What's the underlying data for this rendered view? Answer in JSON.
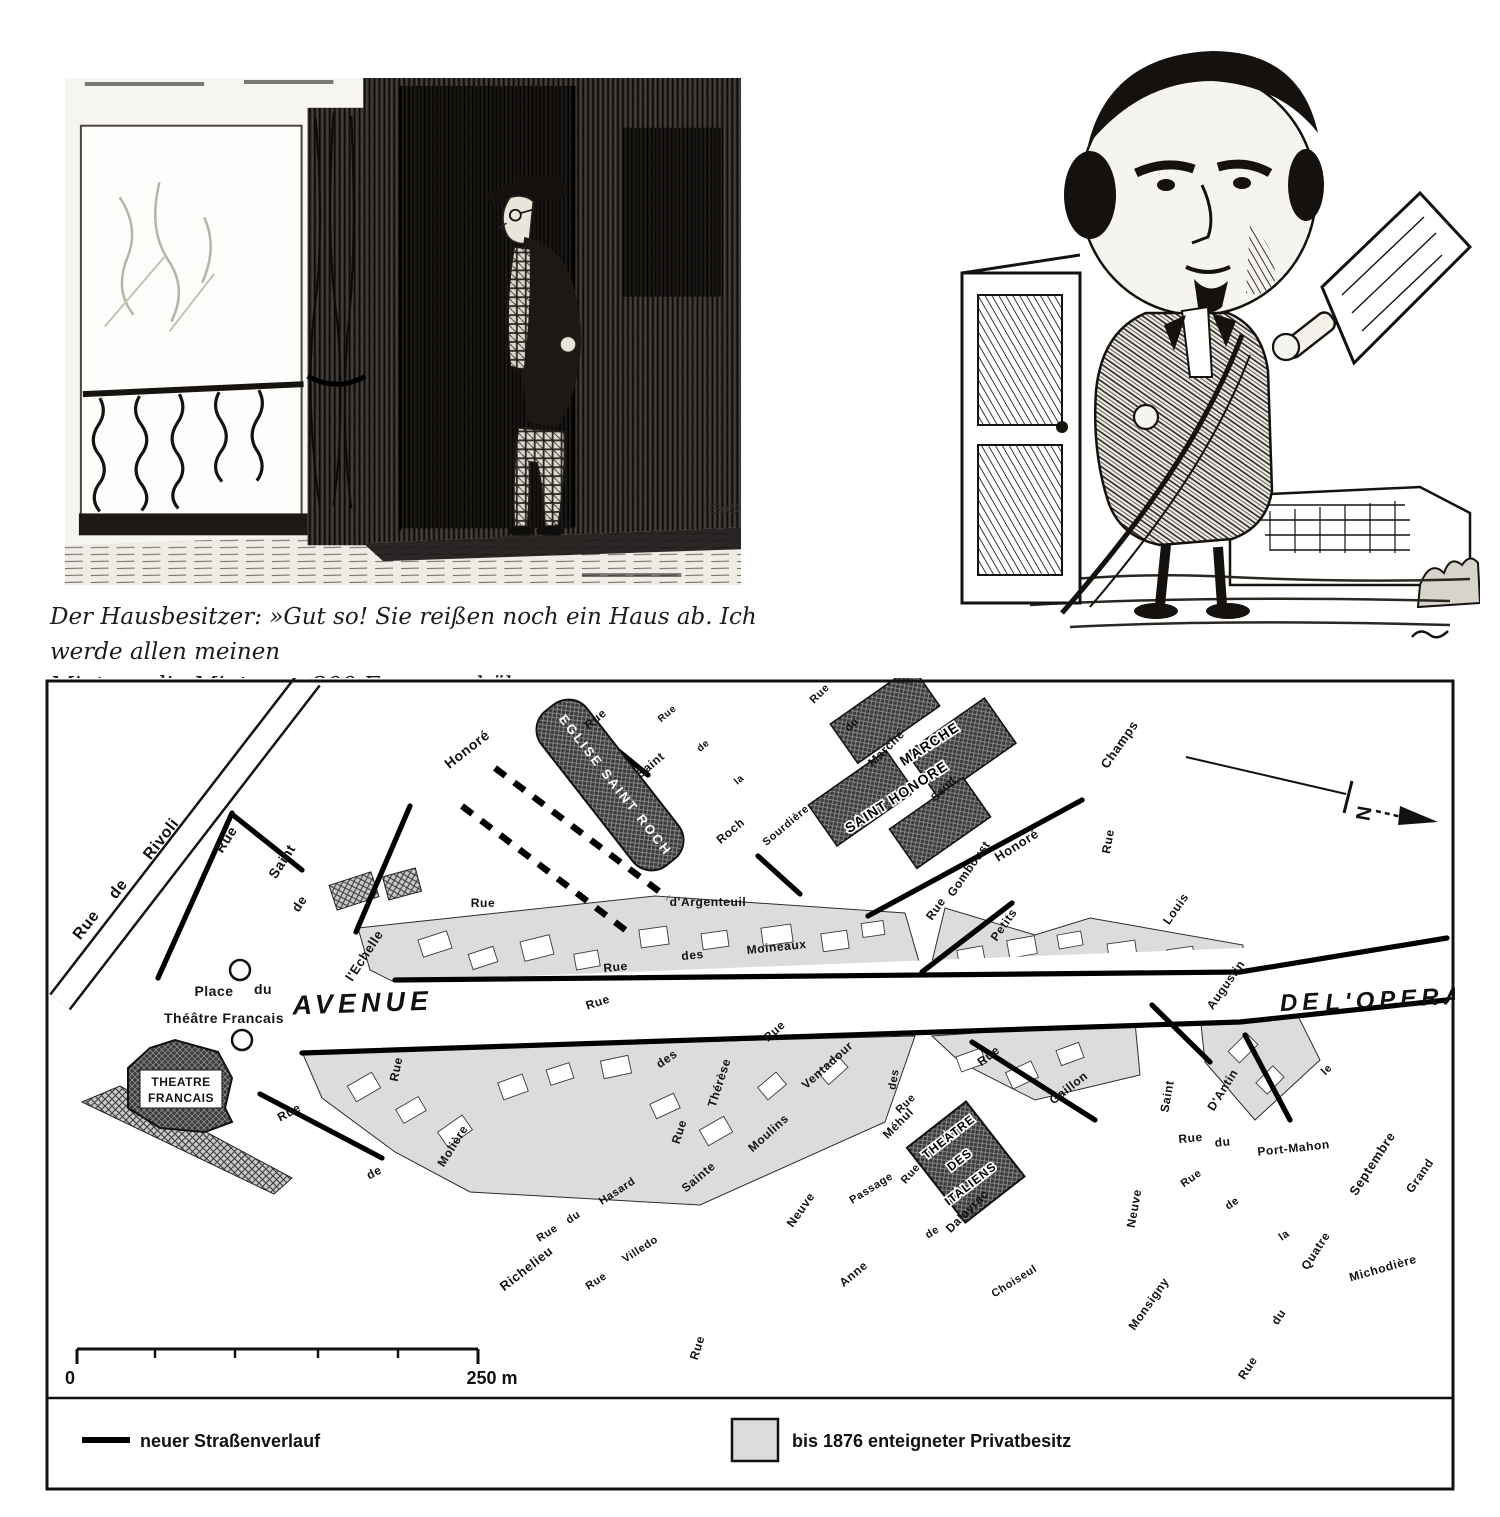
{
  "caption": {
    "lines": [
      "Der Hausbesitzer: »Gut so! Sie reißen noch ein Haus ab. Ich werde allen meinen",
      "Mietern die Miete um 200 Francs erhöhen.«"
    ]
  },
  "illustrations": {
    "left_signature": "GoS"
  },
  "map": {
    "colors": {
      "expropriated_fill": "#dcdcdc",
      "ink": "#111111",
      "new_street": "#000000"
    },
    "north_label": "N",
    "scale": {
      "zero": "0",
      "end": "250 m"
    },
    "legend": {
      "items": [
        {
          "swatch": "line",
          "label": "neuer Straßenverlauf"
        },
        {
          "swatch": "area",
          "label": "bis 1876 enteigneter Privatbesitz"
        }
      ]
    },
    "street_labels": [
      {
        "t": "Rue",
        "x": 90,
        "y": 928,
        "r": -52,
        "s": 16
      },
      {
        "t": "de",
        "x": 122,
        "y": 892,
        "r": -52,
        "s": 16
      },
      {
        "t": "Rivoli",
        "x": 165,
        "y": 842,
        "r": -52,
        "s": 16
      },
      {
        "t": "Rue",
        "x": 230,
        "y": 842,
        "r": -57,
        "s": 14
      },
      {
        "t": "Saint",
        "x": 286,
        "y": 864,
        "r": -57,
        "s": 14
      },
      {
        "t": "de",
        "x": 303,
        "y": 906,
        "r": -57,
        "s": 13
      },
      {
        "t": "l'Echelle",
        "x": 368,
        "y": 958,
        "r": -57,
        "s": 13
      },
      {
        "t": "Honoré",
        "x": 470,
        "y": 753,
        "r": -38,
        "s": 14
      },
      {
        "t": "Rue",
        "x": 598,
        "y": 722,
        "r": -40,
        "s": 12
      },
      {
        "t": "Saint",
        "x": 653,
        "y": 768,
        "r": -40,
        "s": 12
      },
      {
        "t": "Roch",
        "x": 733,
        "y": 834,
        "r": -40,
        "s": 12
      },
      {
        "t": "Rue",
        "x": 669,
        "y": 716,
        "r": -40,
        "s": 10
      },
      {
        "t": "de",
        "x": 705,
        "y": 748,
        "r": -40,
        "s": 10
      },
      {
        "t": "la",
        "x": 741,
        "y": 782,
        "r": -40,
        "s": 10
      },
      {
        "t": "Sourdière",
        "x": 788,
        "y": 828,
        "r": -40,
        "s": 11
      },
      {
        "t": "Rue",
        "x": 483,
        "y": 907,
        "r": 0,
        "s": 12
      },
      {
        "t": "d'Argenteuil",
        "x": 708,
        "y": 906,
        "r": 0,
        "s": 12
      },
      {
        "t": "Rue",
        "x": 616,
        "y": 971,
        "r": -6,
        "s": 12
      },
      {
        "t": "des",
        "x": 693,
        "y": 959,
        "r": -6,
        "s": 12
      },
      {
        "t": "Moineaux",
        "x": 777,
        "y": 951,
        "r": -6,
        "s": 12
      },
      {
        "t": "Rue",
        "x": 599,
        "y": 1006,
        "r": -18,
        "s": 12
      },
      {
        "t": "des",
        "x": 669,
        "y": 1062,
        "r": -35,
        "s": 12
      },
      {
        "t": "Rue",
        "x": 400,
        "y": 1070,
        "r": -78,
        "s": 12
      },
      {
        "t": "Molière",
        "x": 456,
        "y": 1148,
        "r": -58,
        "s": 12
      },
      {
        "t": "Rue",
        "x": 291,
        "y": 1116,
        "r": -28,
        "s": 12
      },
      {
        "t": "de",
        "x": 376,
        "y": 1176,
        "r": -28,
        "s": 12
      },
      {
        "t": "Richelieu",
        "x": 529,
        "y": 1272,
        "r": -38,
        "s": 13
      },
      {
        "t": "Rue",
        "x": 549,
        "y": 1236,
        "r": -33,
        "s": 11
      },
      {
        "t": "du",
        "x": 575,
        "y": 1220,
        "r": -33,
        "s": 11
      },
      {
        "t": "Hasard",
        "x": 619,
        "y": 1194,
        "r": -33,
        "s": 11
      },
      {
        "t": "Rue",
        "x": 598,
        "y": 1284,
        "r": -33,
        "s": 11
      },
      {
        "t": "Villedo",
        "x": 642,
        "y": 1252,
        "r": -33,
        "s": 11
      },
      {
        "t": "Sainte",
        "x": 701,
        "y": 1180,
        "r": -40,
        "s": 12
      },
      {
        "t": "Anne",
        "x": 856,
        "y": 1277,
        "r": -40,
        "s": 12
      },
      {
        "t": "Rue",
        "x": 701,
        "y": 1349,
        "r": -72,
        "s": 12
      },
      {
        "t": "Rue",
        "x": 683,
        "y": 1133,
        "r": -72,
        "s": 12
      },
      {
        "t": "Thérèse",
        "x": 723,
        "y": 1084,
        "r": -72,
        "s": 12
      },
      {
        "t": "Moulins",
        "x": 771,
        "y": 1136,
        "r": -42,
        "s": 12
      },
      {
        "t": "des",
        "x": 897,
        "y": 1080,
        "r": -80,
        "s": 11
      },
      {
        "t": "Rue",
        "x": 908,
        "y": 1106,
        "r": -45,
        "s": 11
      },
      {
        "t": "Méhul",
        "x": 901,
        "y": 1126,
        "r": -45,
        "s": 12
      },
      {
        "t": "Rue",
        "x": 777,
        "y": 1034,
        "r": -42,
        "s": 12
      },
      {
        "t": "Ventadour",
        "x": 830,
        "y": 1068,
        "r": -42,
        "s": 12
      },
      {
        "t": "Rue",
        "x": 913,
        "y": 1176,
        "r": -48,
        "s": 11
      },
      {
        "t": "Dalayrac",
        "x": 970,
        "y": 1214,
        "r": -45,
        "s": 12
      },
      {
        "t": "Passage",
        "x": 873,
        "y": 1191,
        "r": -32,
        "s": 11
      },
      {
        "t": "de",
        "x": 934,
        "y": 1235,
        "r": -32,
        "s": 11
      },
      {
        "t": "Choiseul",
        "x": 1016,
        "y": 1284,
        "r": -32,
        "s": 11
      },
      {
        "t": "Rue",
        "x": 991,
        "y": 1059,
        "r": -38,
        "s": 12
      },
      {
        "t": "Gaillon",
        "x": 1071,
        "y": 1091,
        "r": -38,
        "s": 12
      },
      {
        "t": "Petits",
        "x": 1007,
        "y": 927,
        "r": -55,
        "s": 12
      },
      {
        "t": "Champs",
        "x": 1123,
        "y": 747,
        "r": -55,
        "s": 13
      },
      {
        "t": "Rue",
        "x": 939,
        "y": 911,
        "r": -55,
        "s": 12
      },
      {
        "t": "Gomboust",
        "x": 972,
        "y": 871,
        "r": -55,
        "s": 12
      },
      {
        "t": "Honoré",
        "x": 1019,
        "y": 849,
        "r": -32,
        "s": 13
      },
      {
        "t": "Rue",
        "x": 822,
        "y": 696,
        "r": -45,
        "s": 11
      },
      {
        "t": "du",
        "x": 854,
        "y": 727,
        "r": -45,
        "s": 11
      },
      {
        "t": "Marché",
        "x": 889,
        "y": 751,
        "r": -45,
        "s": 12
      },
      {
        "t": "Saint",
        "x": 946,
        "y": 791,
        "r": -45,
        "s": 11
      },
      {
        "t": "Rue",
        "x": 1112,
        "y": 842,
        "r": -80,
        "s": 12
      },
      {
        "t": "Louis",
        "x": 1179,
        "y": 911,
        "r": -55,
        "s": 12
      },
      {
        "t": "le",
        "x": 1329,
        "y": 1072,
        "r": -45,
        "s": 11
      },
      {
        "t": "Grand",
        "x": 1423,
        "y": 1178,
        "r": -55,
        "s": 12
      },
      {
        "t": "Saint",
        "x": 1171,
        "y": 1097,
        "r": -80,
        "s": 12
      },
      {
        "t": "Augustin",
        "x": 1229,
        "y": 987,
        "r": -55,
        "s": 12
      },
      {
        "t": "D'Antin",
        "x": 1226,
        "y": 1092,
        "r": -58,
        "s": 12
      },
      {
        "t": "Rue",
        "x": 1191,
        "y": 1142,
        "r": -6,
        "s": 12
      },
      {
        "t": "du",
        "x": 1223,
        "y": 1146,
        "r": -6,
        "s": 12
      },
      {
        "t": "Port-Mahon",
        "x": 1294,
        "y": 1152,
        "r": -6,
        "s": 12
      },
      {
        "t": "Rue",
        "x": 1193,
        "y": 1181,
        "r": -35,
        "s": 11
      },
      {
        "t": "de",
        "x": 1234,
        "y": 1206,
        "r": -35,
        "s": 11
      },
      {
        "t": "la",
        "x": 1286,
        "y": 1238,
        "r": -35,
        "s": 11
      },
      {
        "t": "Michodière",
        "x": 1384,
        "y": 1272,
        "r": -16,
        "s": 12
      },
      {
        "t": "Septembre",
        "x": 1376,
        "y": 1166,
        "r": -57,
        "s": 13
      },
      {
        "t": "Quatre",
        "x": 1319,
        "y": 1253,
        "r": -57,
        "s": 12
      },
      {
        "t": "du",
        "x": 1282,
        "y": 1319,
        "r": -57,
        "s": 12
      },
      {
        "t": "Rue",
        "x": 1251,
        "y": 1370,
        "r": -57,
        "s": 12
      },
      {
        "t": "Monsigny",
        "x": 1152,
        "y": 1306,
        "r": -55,
        "s": 12
      },
      {
        "t": "Neuve",
        "x": 1138,
        "y": 1209,
        "r": -80,
        "s": 12
      },
      {
        "t": "Neuve",
        "x": 804,
        "y": 1212,
        "r": -55,
        "s": 12
      },
      {
        "t": "AVENUE",
        "x": 363,
        "y": 1012,
        "r": -2,
        "s": 27,
        "st": "big"
      },
      {
        "t": "DE",
        "x": 1302,
        "y": 1010,
        "r": -3,
        "s": 24,
        "st": "big"
      },
      {
        "t": "L'OPERA",
        "x": 1396,
        "y": 1007,
        "r": -3,
        "s": 24,
        "st": "big"
      },
      {
        "t": "Place",
        "x": 214,
        "y": 996,
        "r": 0,
        "s": 14,
        "st": "place"
      },
      {
        "t": "du",
        "x": 263,
        "y": 994,
        "r": 0,
        "s": 14,
        "st": "place"
      },
      {
        "t": "Théâtre Francais",
        "x": 224,
        "y": 1023,
        "r": 0,
        "s": 14,
        "st": "place"
      },
      {
        "t": "EGLISE SAINT ROCH",
        "x": 612,
        "y": 788,
        "r": 52,
        "s": 13,
        "st": "white"
      },
      {
        "t": "MARCHE",
        "x": 932,
        "y": 748,
        "r": -33,
        "s": 14,
        "st": "halo"
      },
      {
        "t": "SAINT HONORE",
        "x": 899,
        "y": 801,
        "r": -33,
        "s": 14,
        "st": "halo"
      },
      {
        "t": "THEATRE",
        "x": 181,
        "y": 1086,
        "r": 0,
        "s": 12,
        "st": "place"
      },
      {
        "t": "FRANCAIS",
        "x": 181,
        "y": 1102,
        "r": 0,
        "s": 12,
        "st": "place"
      },
      {
        "t": "THEATRE",
        "x": 951,
        "y": 1140,
        "r": -38,
        "s": 12,
        "st": "halo"
      },
      {
        "t": "DES",
        "x": 962,
        "y": 1163,
        "r": -38,
        "s": 12,
        "st": "halo"
      },
      {
        "t": "ITALIENS",
        "x": 973,
        "y": 1187,
        "r": -38,
        "s": 12,
        "st": "halo"
      }
    ]
  }
}
